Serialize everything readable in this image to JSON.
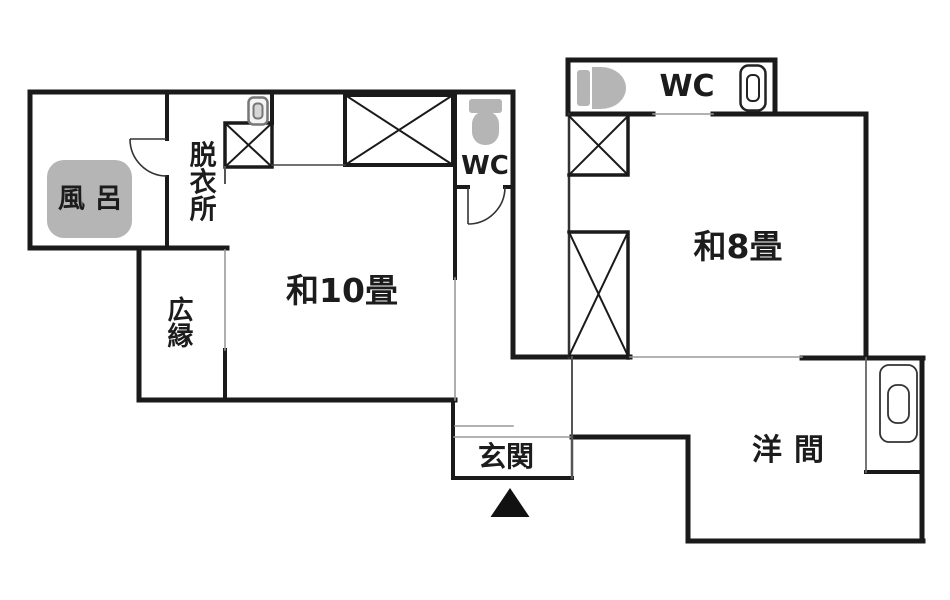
{
  "colors": {
    "background": "#ffffff",
    "wall": "#1a1a1a",
    "open_boundary": "#999999",
    "medium_line": "#555555",
    "fixture_gray": "#b5b5b5",
    "text": "#1c1c1c",
    "entrance_marker": "#111111"
  },
  "rooms": {
    "bath": {
      "label": "風呂"
    },
    "dressing": {
      "label": "脱衣所"
    },
    "veranda": {
      "label": "広縁"
    },
    "japanese10": {
      "label": "和10畳"
    },
    "hall_wc": {
      "label": "WC"
    },
    "upper_wc": {
      "label": "WC"
    },
    "entrance": {
      "label": "玄関"
    },
    "japanese8": {
      "label": "和8畳"
    },
    "western": {
      "label": "洋間"
    }
  },
  "icons": [
    "bathtub-icon",
    "toilet-icon",
    "washbasin-icon",
    "closet-cross-icon",
    "door-swing-icon",
    "entrance-direction-marker"
  ]
}
